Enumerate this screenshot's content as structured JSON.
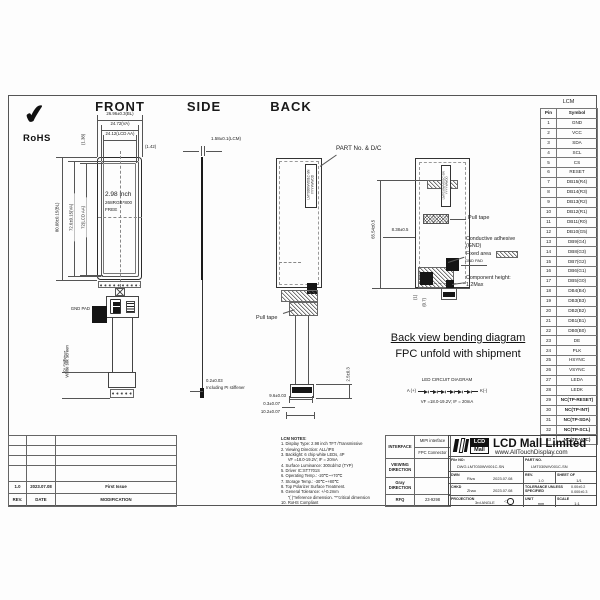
{
  "view_titles": {
    "front": "FRONT",
    "side": "SIDE",
    "back": "BACK"
  },
  "rohs": {
    "check": "✔",
    "label": "RoHS"
  },
  "front": {
    "dim_bl_w": "26.96±0.3(BL)",
    "dim_va_w": "24.72(VA)",
    "dim_aa_w": "24.12(LCD AA)",
    "dim_offset_r": "(1.42)",
    "dim_offset_t": "(1.38)",
    "dim_bl_h": "80.08±0.15(BL)",
    "dim_va_h": "72.6±0.15(VA)",
    "dim_aa_h": "72(LCD AA)",
    "screen_line1": "2.98 inch",
    "screen_line2": "268RGB*800",
    "screen_line3": "FREE",
    "gnd_pad": "GND PAD",
    "dim_stiffener": "4±0.3",
    "stiffener_label": "PI Stiffener",
    "dim_silk": "2.5±0.3",
    "silk_label": "White silk screen"
  },
  "side": {
    "dim_thickness": "1.58±0.1(LCM)",
    "dim_fpc_thk1": "0.2±0.03",
    "dim_fpc_thk2": "Including PI stiffener"
  },
  "back": {
    "part_label": "PART No. & D/C",
    "sticker_line1": "LMT030WV001C-SN",
    "sticker_line2": "YYYYWWDD",
    "pull_tape_1": "Pull tape",
    "pull_tape_2": "Pull tape",
    "conductive_1": "Conductive adhesive",
    "conductive_2": "(GND)",
    "fixed_area": "Fixed area",
    "gnd_pad": "GND PAD",
    "comp_height_1": "Component height:",
    "comp_height_2": "1.2Max",
    "dim_total_h": "65.54±0.5",
    "dim_top": "8.38±0.5",
    "dim_gap1": "(1)",
    "dim_gap2": "(0.7)",
    "dim_conn_w1": "9.6±0.03",
    "dim_conn_w2": "0.3±0.07",
    "dim_conn_w3": "10.2±0.07",
    "dim_conn_h": "2.5±0.3",
    "bend_note_1": "Back view bending diagram",
    "bend_note_2": "FPC unfold with shipment"
  },
  "led_diagram": {
    "title": "LED CIRCUIT DIAGRAM",
    "anode": "A (+)",
    "cathode": "K(-)",
    "spec": "VF =18.0-19.2V; IF = 20mA"
  },
  "pin_table": {
    "title": "LCM",
    "headers": [
      "Pin",
      "Symbol"
    ],
    "rows": [
      [
        "1",
        "GND"
      ],
      [
        "2",
        "VCC"
      ],
      [
        "3",
        "SDA"
      ],
      [
        "4",
        "SCL"
      ],
      [
        "5",
        "CS"
      ],
      [
        "6",
        "RESET"
      ],
      [
        "7",
        "DB15(R4)"
      ],
      [
        "8",
        "DB14(R3)"
      ],
      [
        "9",
        "DB13(R2)"
      ],
      [
        "10",
        "DB12(R1)"
      ],
      [
        "11",
        "DB11(R0)"
      ],
      [
        "12",
        "DB10(G5)"
      ],
      [
        "13",
        "DB9(G4)"
      ],
      [
        "14",
        "DB8(G3)"
      ],
      [
        "15",
        "DB7(G2)"
      ],
      [
        "16",
        "DB6(G1)"
      ],
      [
        "17",
        "DB5(G0)"
      ],
      [
        "18",
        "DB4(B4)"
      ],
      [
        "19",
        "DB3(B3)"
      ],
      [
        "20",
        "DB2(B2)"
      ],
      [
        "21",
        "DB1(B1)"
      ],
      [
        "22",
        "DB0(B0)"
      ],
      [
        "23",
        "DE"
      ],
      [
        "24",
        "PLK"
      ],
      [
        "25",
        "HSYNC"
      ],
      [
        "26",
        "VSYNC"
      ],
      [
        "27",
        "LEDA"
      ],
      [
        "28",
        "LEDK"
      ],
      [
        "29",
        "NC(TP-RESET)"
      ],
      [
        "30",
        "NC(TP-INT)"
      ],
      [
        "31",
        "NC(TP-SDA)"
      ],
      [
        "32",
        "NC(TP-SCL)"
      ],
      [
        "33",
        "NC(TP-VCC)"
      ]
    ]
  },
  "notes": {
    "lines": [
      "LCM NOTES:",
      "1. Display Type: 2.98 inch TFT /Transmissive",
      "2. Viewing Direction: ALL/IPS",
      "3. Backlight: 6 chip white LEDs, 4P",
      "      VF =18.0-19.2V; IF = 20mA",
      "4. Surface Luminance: 300cd/m2 (TYP)",
      "5. Driver IC:ST7701S",
      "6. Operating Temp.: -20℃~+70℃",
      "7. Storage Temp.: -30℃~+80℃",
      "8. Top Polarizer Surface Treatment.",
      "9. General Tolerance: +/-0.2mm",
      "      \"( )\"reference dimension. \"*\"critical dimension",
      "10. RoHS Compliant"
    ]
  },
  "spec_table": {
    "interface_label": "INTERFACE",
    "interface_v1": "MIPI interface",
    "interface_v2": "FPC Connector",
    "viewing_label_1": "VIEWING",
    "viewing_label_2": "DIRECTION",
    "gray_label_1": "Gray",
    "gray_label_2": "DIRECTION",
    "rfq_label": "RFQ",
    "rfq_value": "23-9298"
  },
  "title_block": {
    "logo_lcd": "LCD",
    "logo_mall": "Mall",
    "company": "LCD Mall Limited",
    "website": "www.AllTouchDisplay.com",
    "file_no_label": "File NO:",
    "file_no": "DWG.LMT030WV001C-SN",
    "part_no_label": "PART NO.",
    "part_no": "LMT030WV001C-SN",
    "dwn_label": "DWN",
    "dwn_name": "Riva",
    "dwn_date": "2023.07.08",
    "rev_label": "REV.",
    "rev_value": "1.0",
    "sheet_label": "SHEET OF",
    "sheet_value": "1/1",
    "chkd_label": "CHKD",
    "chkd_name": "Zhao",
    "chkd_date": "2023.07.08",
    "tol_label_1": "TOLERANCE UNLESS",
    "tol_label_2": "SPECIFIED",
    "tol_v1": "0.00±0.2",
    "tol_v2": "0.000±0.3",
    "proj_label": "PROJECTION",
    "proj_value": "3rd ANGLE",
    "unit_label": "UNIT",
    "unit_value": "mm",
    "scale_label": "SCALE",
    "scale_value": "1:1"
  },
  "revision_table": {
    "data_row": [
      "1.0",
      "2023.07.08",
      "First Issue"
    ],
    "headers": [
      "REV.",
      "DATE",
      "MODIFICATION"
    ]
  }
}
